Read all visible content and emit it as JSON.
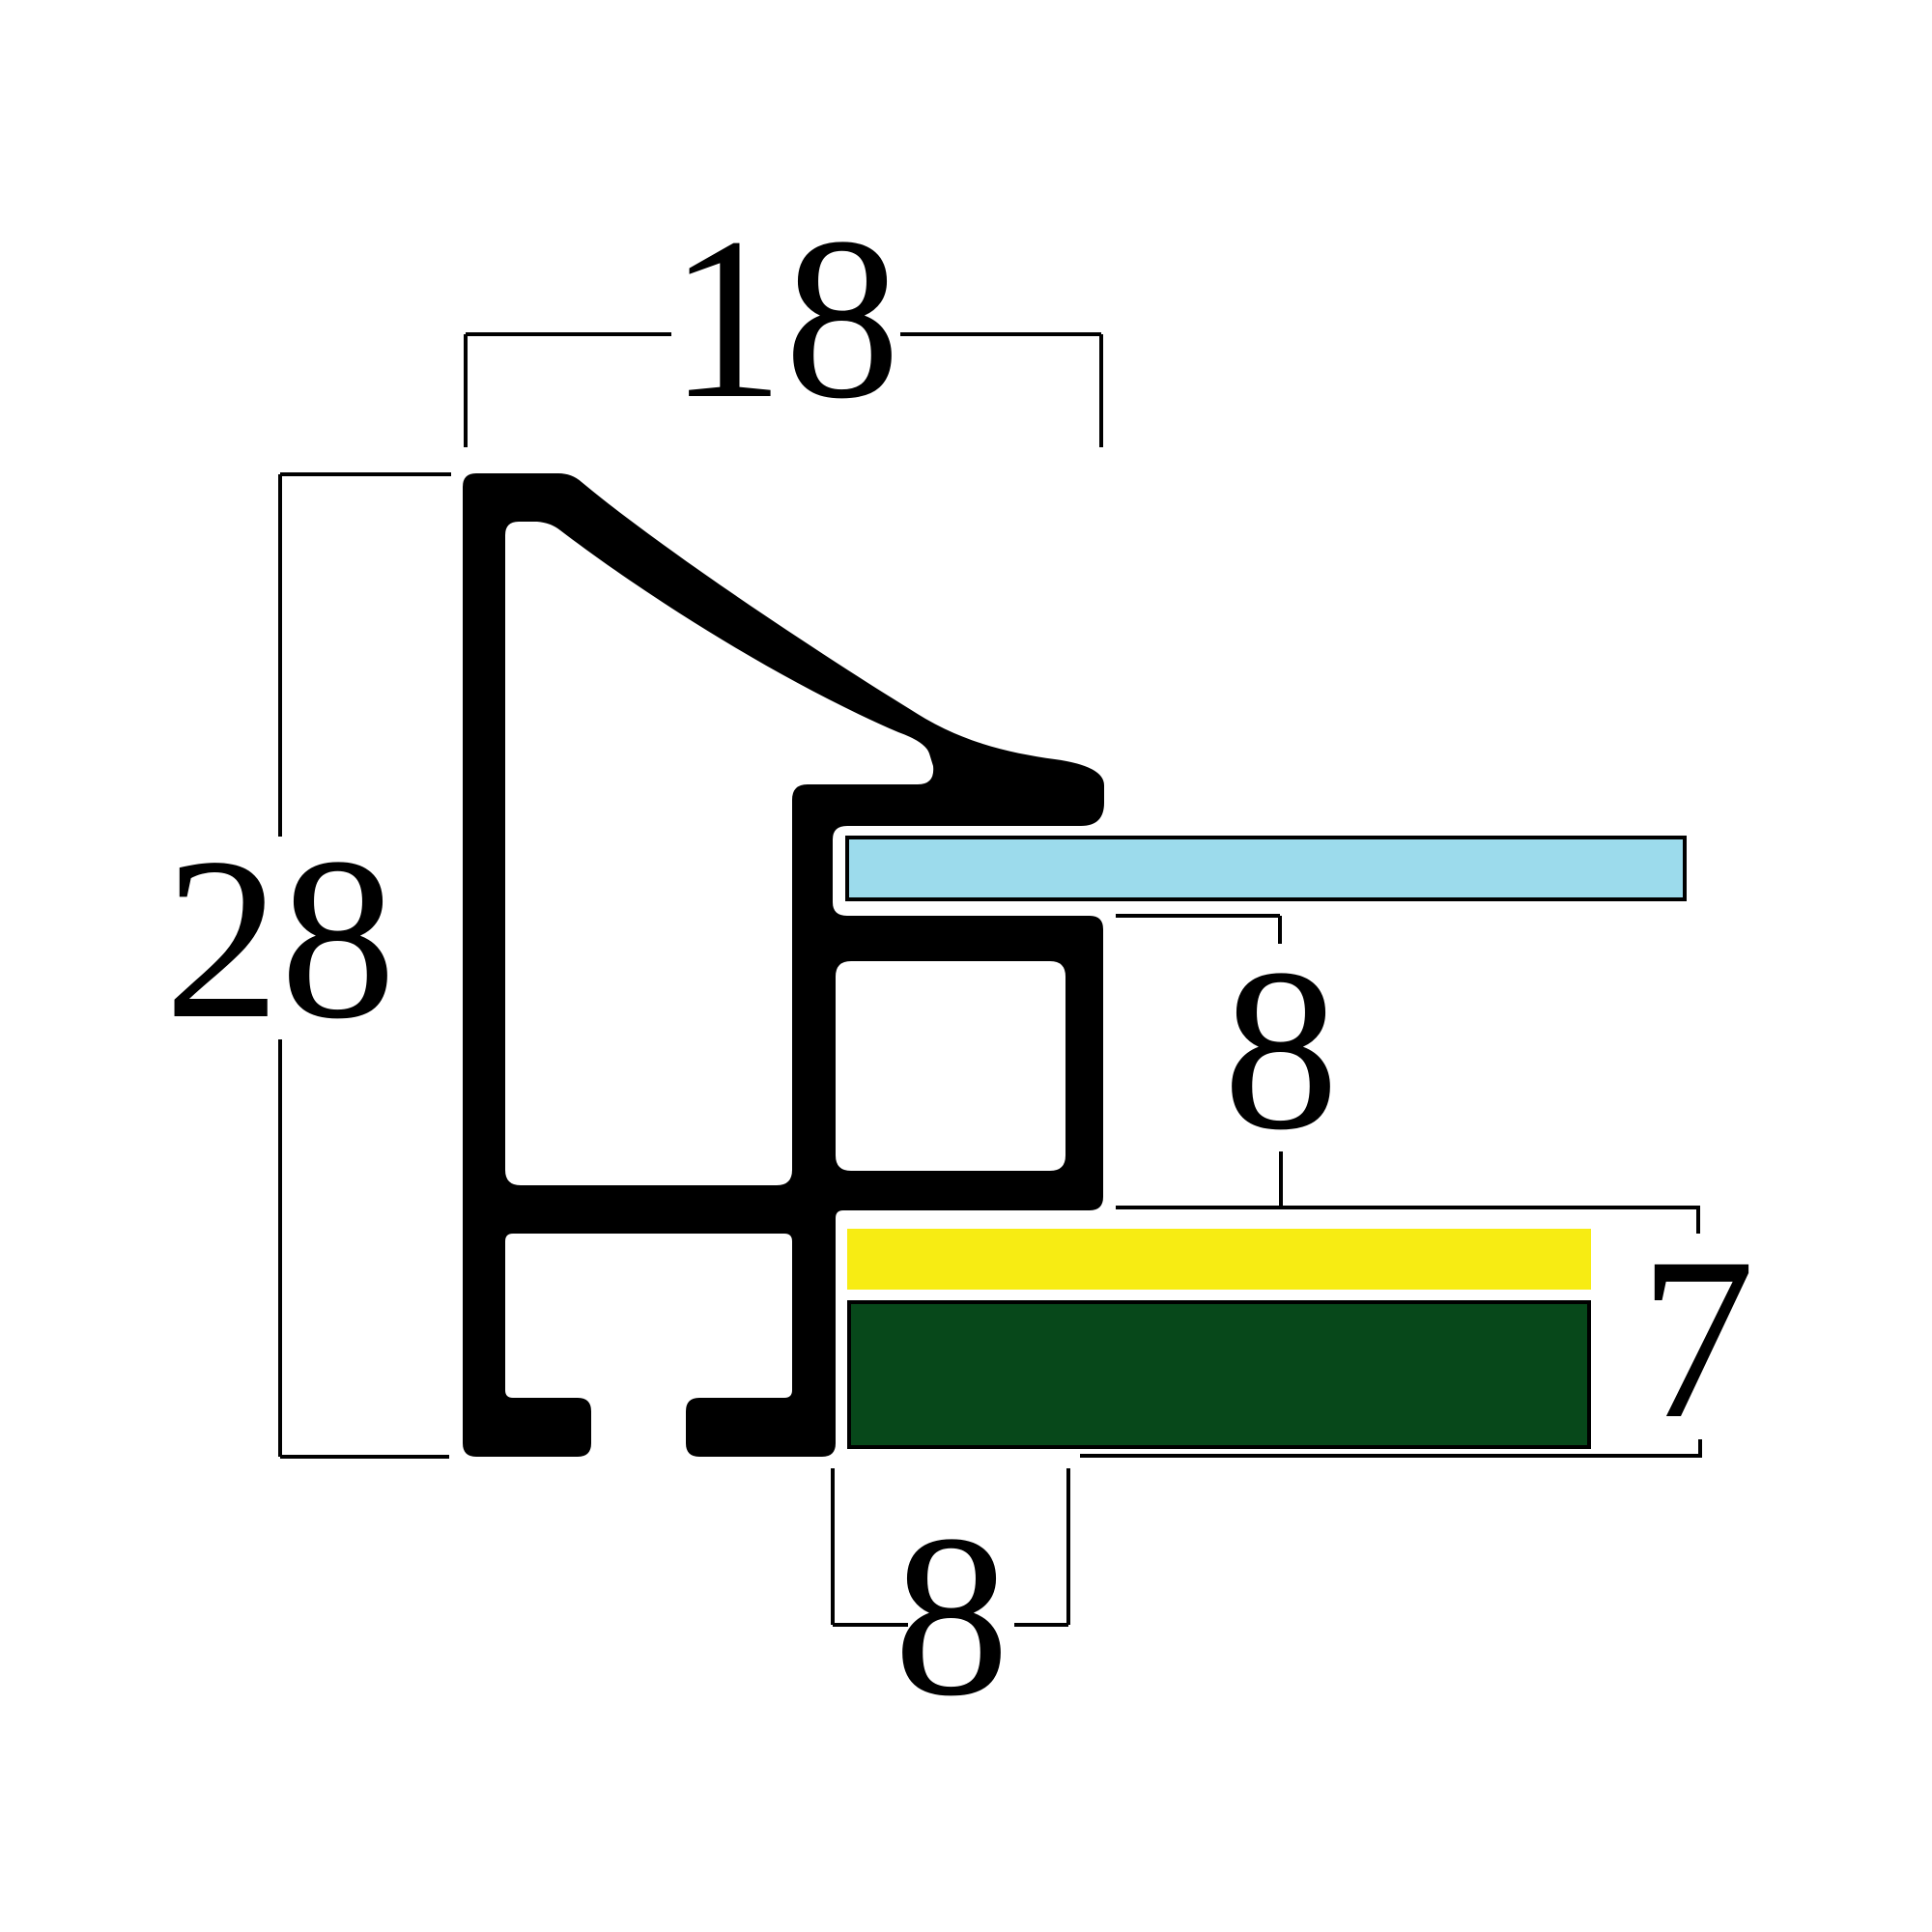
{
  "dimensions": {
    "top_width": {
      "label": "18"
    },
    "left_height": {
      "label": "28"
    },
    "rabbet_depth": {
      "label": "8"
    },
    "right_height": {
      "label": "7"
    },
    "bottom_width": {
      "label": "8"
    }
  },
  "colors": {
    "background": "#ffffff",
    "profile": "#000000",
    "dimension_line": "#000000",
    "glass": "#9cdbec",
    "board_yellow": "#f7ec13",
    "board_green": "#07481a"
  }
}
